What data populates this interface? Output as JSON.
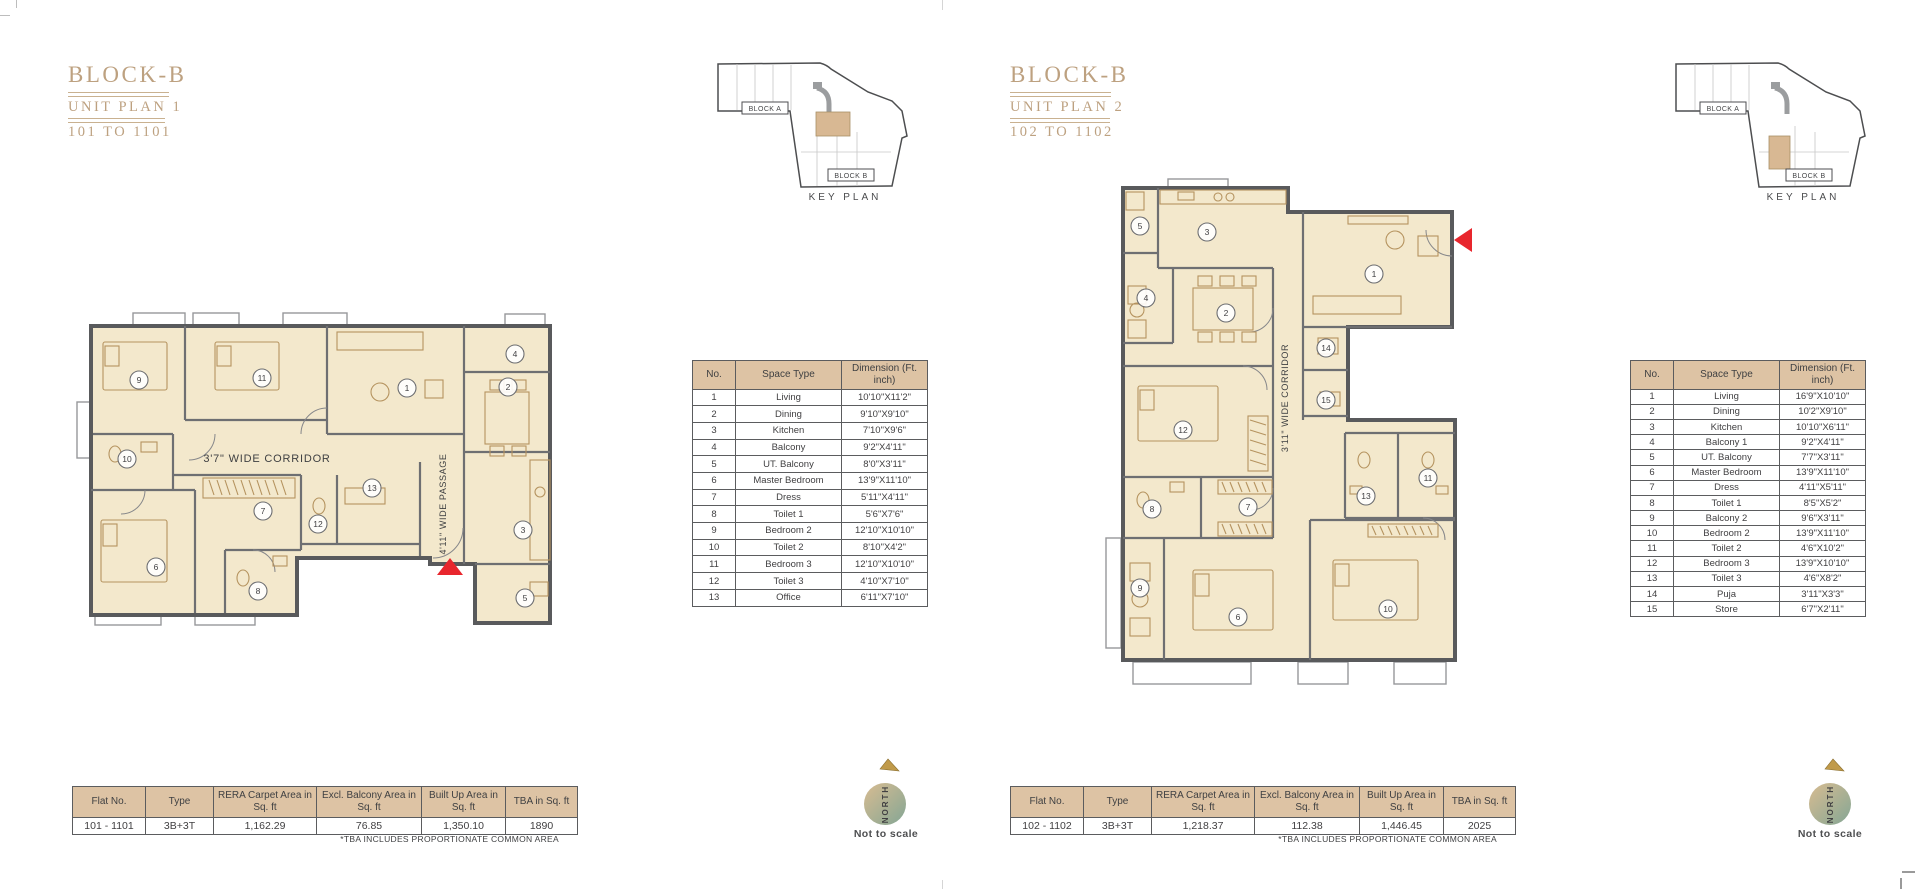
{
  "meta": {
    "not_to_scale": "Not to scale",
    "tba_note": "*TBA INCLUDES PROPORTIONATE COMMON AREA",
    "key_plan_label": "KEY PLAN",
    "block_a_label": "BLOCK A",
    "block_b_label": "BLOCK B",
    "north_label": "NORTH"
  },
  "colors": {
    "accent_gold": "#BDA180",
    "rule_gold": "#C9B190",
    "table_header_bg": "#DDC3A4",
    "wall_gray": "#595A5C",
    "room_fill": "#F3E8CC",
    "furniture_tan": "#B5935F",
    "entry_red": "#E8262D",
    "text_gray": "#414042",
    "north_gradient_start": "#D8BC92",
    "north_gradient_end": "#84A694"
  },
  "units": [
    {
      "block": "BLOCK-B",
      "plan_name": "UNIT PLAN 1",
      "unit_range": "101 TO 1101",
      "corridor_label": "3'7\" WIDE CORRIDOR",
      "passage_label": "4'11\" WIDE PASSAGE",
      "dim_table": {
        "col_headers": [
          "No.",
          "Space Type",
          "Dimension (Ft. inch)"
        ],
        "rows": [
          [
            "1",
            "Living",
            "10'10\"X11'2\""
          ],
          [
            "2",
            "Dining",
            "9'10\"X9'10\""
          ],
          [
            "3",
            "Kitchen",
            "7'10\"X9'6\""
          ],
          [
            "4",
            "Balcony",
            "9'2\"X4'11\""
          ],
          [
            "5",
            "UT. Balcony",
            "8'0\"X3'11\""
          ],
          [
            "6",
            "Master Bedroom",
            "13'9\"X11'10\""
          ],
          [
            "7",
            "Dress",
            "5'11\"X4'11\""
          ],
          [
            "8",
            "Toilet 1",
            "5'6\"X7'6\""
          ],
          [
            "9",
            "Bedroom 2",
            "12'10\"X10'10\""
          ],
          [
            "10",
            "Toilet 2",
            "8'10\"X4'2\""
          ],
          [
            "11",
            "Bedroom 3",
            "12'10\"X10'10\""
          ],
          [
            "12",
            "Toilet 3",
            "4'10\"X7'10\""
          ],
          [
            "13",
            "Office",
            "6'11\"X7'10\""
          ]
        ]
      },
      "summary": {
        "col_headers": [
          "Flat No.",
          "Type",
          "RERA Carpet Area in Sq. ft",
          "Excl. Balcony Area in Sq. ft",
          "Built Up Area in Sq. ft",
          "TBA in Sq. ft"
        ],
        "row": [
          "101 - 1101",
          "3B+3T",
          "1,162.29",
          "76.85",
          "1,350.10",
          "1890"
        ]
      }
    },
    {
      "block": "BLOCK-B",
      "plan_name": "UNIT PLAN 2",
      "unit_range": "102 TO 1102",
      "corridor_label": "3'11\" WIDE CORRIDOR",
      "passage_label": "",
      "dim_table": {
        "col_headers": [
          "No.",
          "Space Type",
          "Dimension (Ft. inch)"
        ],
        "rows": [
          [
            "1",
            "Living",
            "16'9\"X10'10\""
          ],
          [
            "2",
            "Dining",
            "10'2\"X9'10\""
          ],
          [
            "3",
            "Kitchen",
            "10'10\"X6'11\""
          ],
          [
            "4",
            "Balcony 1",
            "9'2\"X4'11\""
          ],
          [
            "5",
            "UT. Balcony",
            "7'7\"X3'11\""
          ],
          [
            "6",
            "Master Bedroom",
            "13'9\"X11'10\""
          ],
          [
            "7",
            "Dress",
            "4'11\"X5'11\""
          ],
          [
            "8",
            "Toilet 1",
            "8'5\"X5'2\""
          ],
          [
            "9",
            "Balcony 2",
            "9'6\"X3'11\""
          ],
          [
            "10",
            "Bedroom 2",
            "13'9\"X11'10\""
          ],
          [
            "11",
            "Toilet 2",
            "4'6\"X10'2\""
          ],
          [
            "12",
            "Bedroom 3",
            "13'9\"X10'10\""
          ],
          [
            "13",
            "Toilet 3",
            "4'6\"X8'2\""
          ],
          [
            "14",
            "Puja",
            "3'11\"X3'3\""
          ],
          [
            "15",
            "Store",
            "6'7\"X2'11\""
          ]
        ]
      },
      "summary": {
        "col_headers": [
          "Flat No.",
          "Type",
          "RERA Carpet Area in Sq. ft",
          "Excl. Balcony Area in Sq. ft",
          "Built Up Area in Sq. ft",
          "TBA in Sq. ft"
        ],
        "row": [
          "102 - 1102",
          "3B+3T",
          "1,218.37",
          "112.38",
          "1,446.45",
          "2025"
        ]
      }
    }
  ]
}
